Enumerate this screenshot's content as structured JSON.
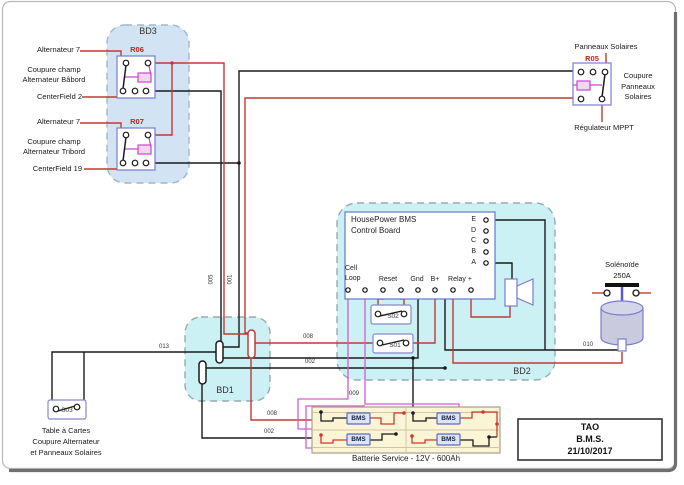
{
  "diagram": {
    "bd1": {
      "label": "BD1"
    },
    "bd2": {
      "label": "BD2"
    },
    "bd3": {
      "label": "BD3"
    },
    "relays": {
      "r06": {
        "id": "R06",
        "input": "Alternateur 7",
        "desc": "Coupure champ\nAlternateur Bâbord",
        "output": "CenterField 2"
      },
      "r07": {
        "id": "R07",
        "input": "Alternateur 7",
        "desc": "Coupure champ\nAlternateur Tribord",
        "output": "CenterField 19"
      },
      "r05": {
        "id": "R05",
        "top": "Panneaux Solaires",
        "desc": "Coupure\nPanneaux\nSolaires",
        "bottom": "Régulateur MPPT"
      }
    },
    "board": {
      "title": "HousePower BMS\nControl Board",
      "terminals_right": [
        "E",
        "D",
        "C",
        "B",
        "A"
      ],
      "terminals_bottom": {
        "cell_loop": "Cell\nLoop",
        "reset": "Reset",
        "gnd": "Gnd",
        "bplus": "B+",
        "relay": "Relay +"
      }
    },
    "switches": {
      "s01": "S01",
      "s02": "S02",
      "s03": "S03"
    },
    "s03_caption": "Table à Cartes\nCoupure Alternateur\net Panneaux Solaires",
    "solenoid": {
      "name": "Solénoïde",
      "rating": "250A"
    },
    "battery": {
      "caption": "Batterie Service - 12V - 600Ah",
      "module": "BMS"
    },
    "title_block": "TAO\nB.M.S.\n21/10/2017",
    "wire_labels": {
      "w005": "005",
      "w001": "001",
      "w013": "013",
      "w008a": "008",
      "w008b": "008",
      "w002a": "002",
      "w002b": "002",
      "w009": "009",
      "w010": "010"
    },
    "colors": {
      "wire_red": "#bf3b34",
      "wire_black": "#1a1a1a",
      "wire_magenta": "#d05fd0",
      "coil_magenta": "#cc44cc",
      "relay_border": "#7b7bd0",
      "bd_cyan_fill": "#ccf1f5",
      "bd3_blue_fill": "#d2e4f4",
      "battery_fill": "#fbf4d5",
      "solenoid_fill": "#c9cade",
      "label_red": "#c22222"
    }
  }
}
